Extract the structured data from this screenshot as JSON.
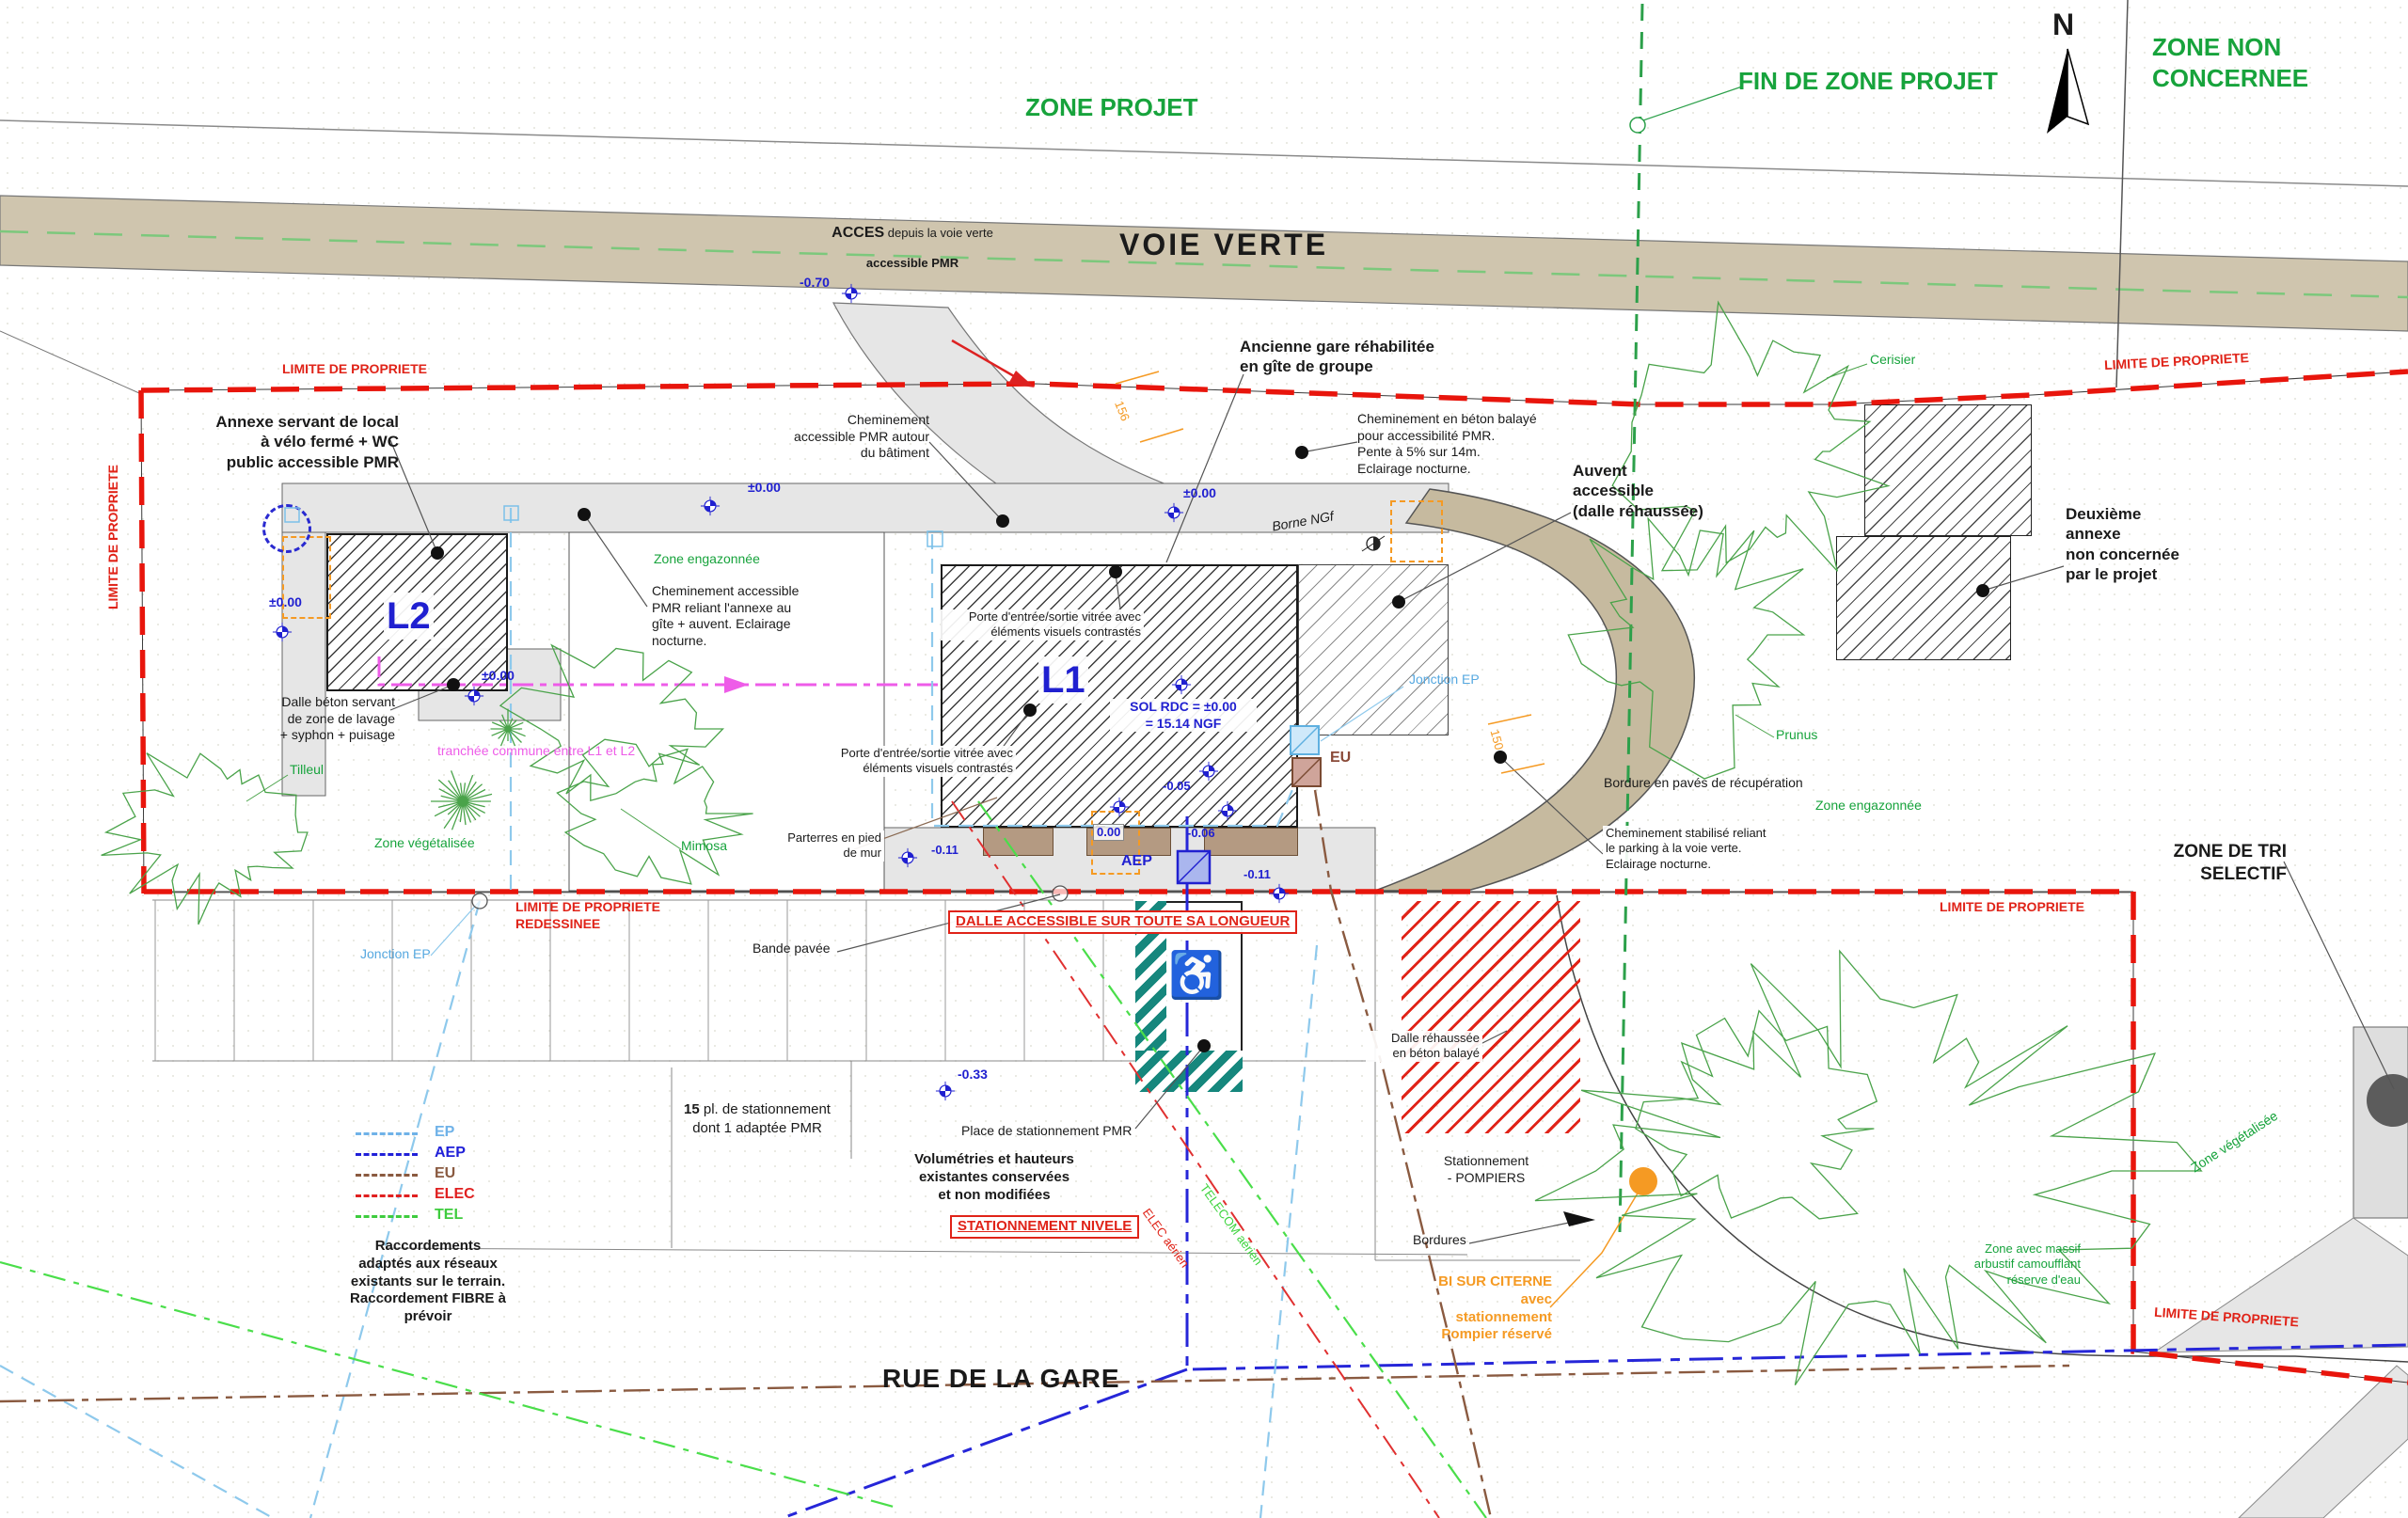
{
  "zones": {
    "projet": "ZONE PROJET",
    "fin_projet": "FIN DE ZONE PROJET",
    "non_concernee": "ZONE NON\nCONCERNEE",
    "north": "N",
    "tri": "ZONE DE TRI\nSELECTIF"
  },
  "roads": {
    "voie_verte": "VOIE VERTE",
    "rue": "RUE DE LA GARE",
    "acces_bold": "ACCES",
    "acces_rest": " depuis la voie verte",
    "acces_pmr": "accessible PMR"
  },
  "property": {
    "limite": "LIMITE DE PROPRIETE",
    "redessinee": "LIMITE DE PROPRIETE\nREDESSINEE"
  },
  "buildings": {
    "l1": "L1",
    "l2": "L2",
    "sol": "SOL RDC = ±0.00\n= 15.14 NGF",
    "borne": "Borne NGf",
    "annexe": "Annexe servant de local\nà vélo fermé + WC\npublic accessible PMR",
    "ancienne": "Ancienne gare réhabilitée\nen gîte de groupe",
    "deuxieme": "Deuxième\nannexe\nnon concernée\npar le projet",
    "auvent": "Auvent\naccessible\n(dalle réhaussée)"
  },
  "annotations": {
    "chem_autour": "Cheminement\naccessible PMR autour\ndu bâtiment",
    "chem_beton": "Cheminement en béton balayé\npour accessibilité PMR.\nPente à 5% sur 14m.\nEclairage nocturne.",
    "chem_reliant": "Cheminement accessible\nPMR reliant l'annexe au\ngîte + auvent. Eclairage\nnocturne.",
    "chem_stab": "Cheminement stabilisé reliant\nle parking à la voie verte.\nEclairage nocturne.",
    "porte": "Porte d'entrée/sortie vitrée avec\néléments visuels contrastés",
    "dalle_lavage": "Dalle béton servant\nde zone de lavage\n+ syphon + puisage",
    "parterres": "Parterres en pied\nde mur",
    "bande_pavee": "Bande pavée",
    "bordure_paves": "Bordure en pavés de récupération",
    "bordures": "Bordures",
    "dalle_rehaussee": "Dalle réhaussée\nen béton balayé",
    "stat_pompiers": "Stationnement\n- POMPIERS",
    "place_pmr": "Place de stationnement PMR",
    "volumetries": "Volumétries et hauteurs\nexistantes conservées\net non modifiées",
    "parking_count": "15",
    "parking_l1": " pl. de stationnement",
    "parking_l2": "dont 1 adaptée PMR",
    "raccordements": "Raccordements\nadaptés aux réseaux\nexistants sur le terrain.\nRaccordement FIBRE à\nprévoir",
    "bi_citerne": "BI SUR CITERNE\navec stationnement\nPompier réservé",
    "dalle_accessible": "DALLE ACCESSIBLE SUR TOUTE SA LONGUEUR",
    "stat_nivele": "STATIONNEMENT NIVELE",
    "tranchee": "tranchée commune entre L1 et L2"
  },
  "plants": {
    "zone_engazonnee": "Zone engazonnée",
    "zone_vegetalisee": "Zone végétalisée",
    "tilleul": "Tilleul",
    "mimosa": "Mimosa",
    "cerisier": "Cerisier",
    "prunus": "Prunus",
    "massif": "Zone avec massif\narbustif camoufflant\nréserve d'eau"
  },
  "networks": {
    "legend": [
      {
        "label": "EP",
        "color": "#6fb2e8"
      },
      {
        "label": "AEP",
        "color": "#2020d8"
      },
      {
        "label": "EU",
        "color": "#8a5a40"
      },
      {
        "label": "ELEC",
        "color": "#e02020"
      },
      {
        "label": "TEL",
        "color": "#3ecc3e"
      }
    ],
    "jonction_ep": "Jonction EP",
    "telecom": "TELECOM aérien",
    "elec": "ELEC aérien",
    "eu": "EU",
    "aep": "AEP"
  },
  "elevations": {
    "m070": "-0.70",
    "p000": "±0.00",
    "z000": "0.00",
    "m005": "-0.05",
    "m006": "-0.06",
    "m011": "-0.11",
    "m033": "-0.33"
  },
  "dims": {
    "d156": "156",
    "d150": "150"
  },
  "colors": {
    "green": "#17a33c",
    "red": "#e02318",
    "blue": "#2020d0",
    "lightblue": "#6fb2e8",
    "magenta": "#ee5ce8",
    "orange": "#f59a23",
    "brown": "#8a5a40",
    "teal": "#16877d",
    "tan": "#cfc5ae",
    "gray": "#e6e6e6"
  }
}
